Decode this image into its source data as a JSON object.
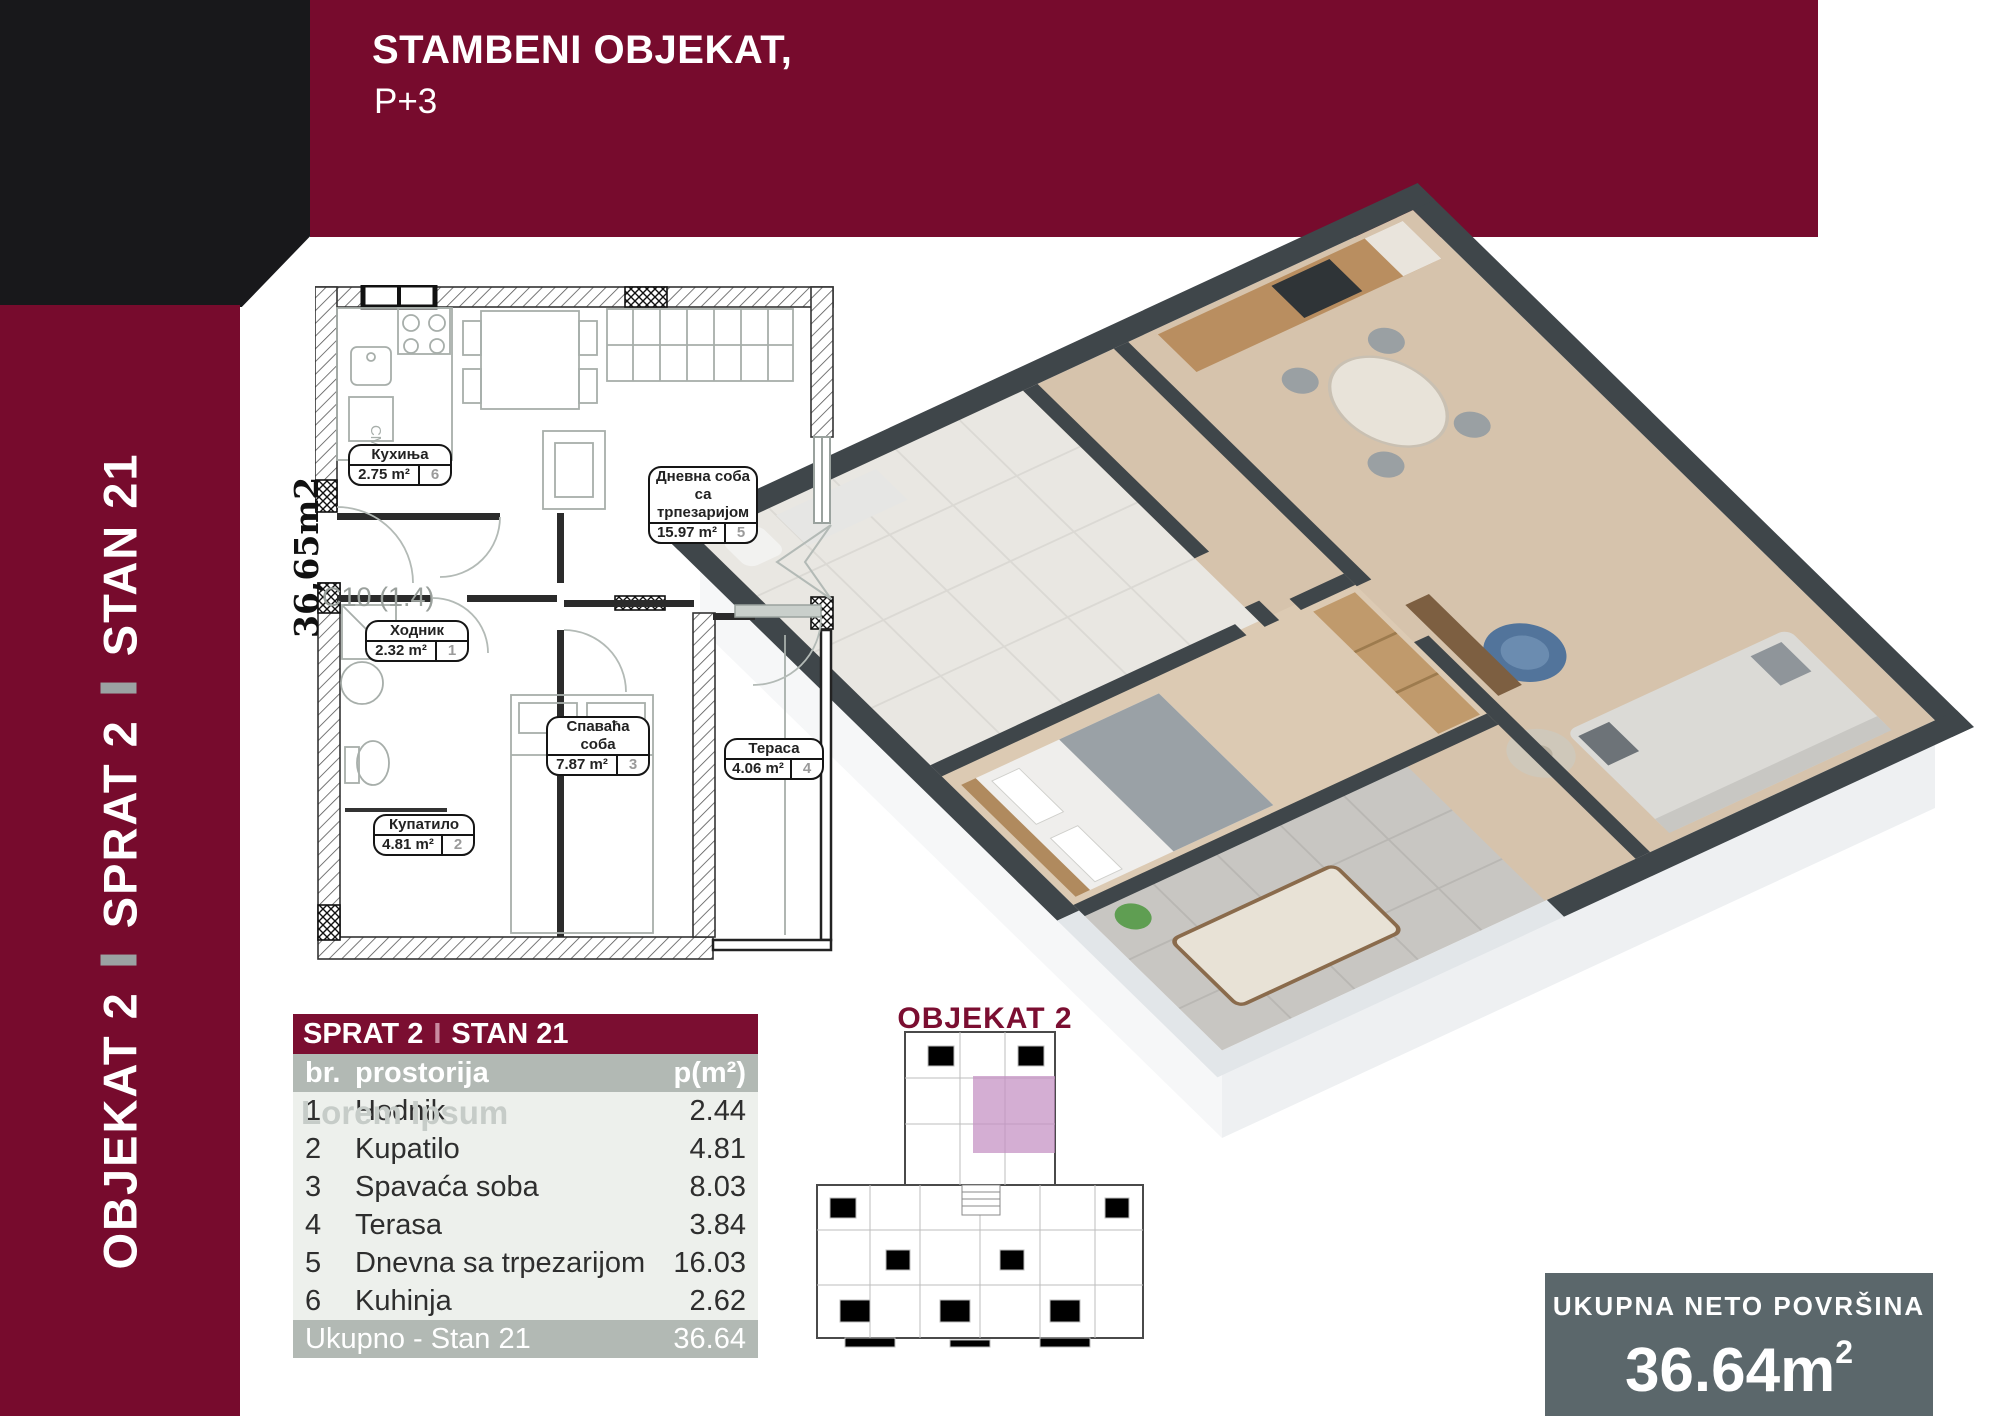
{
  "header": {
    "title": "STAMBENI OBJEKAT,",
    "subtitle": "P+3"
  },
  "sidebar": {
    "segments": [
      "OBJEKAT 2",
      "SPRAT 2",
      "STAN 21"
    ]
  },
  "floorplan": {
    "side_area": "36,65m2",
    "unit_code": "C10 (1.4)",
    "washer_label": "СМ",
    "rooms": [
      {
        "l1": "Кухиња",
        "l2": "",
        "area": "2.75 m²",
        "num": "6"
      },
      {
        "l1": "Дневна соба са",
        "l2": "трпезаријом",
        "area": "15.97 m²",
        "num": "5"
      },
      {
        "l1": "Ходник",
        "l2": "",
        "area": "2.32 m²",
        "num": "1"
      },
      {
        "l1": "Спаваћа соба",
        "l2": "",
        "area": "7.87 m²",
        "num": "3"
      },
      {
        "l1": "Купатило",
        "l2": "",
        "area": "4.81 m²",
        "num": "2"
      },
      {
        "l1": "Тераса",
        "l2": "",
        "area": "4.06 m²",
        "num": "4"
      }
    ]
  },
  "keyplan": {
    "title": "OBJEKAT 2"
  },
  "table": {
    "title1": "SPRAT 2",
    "title_sep": "I",
    "title2": "STAN 21",
    "watermark": "Lorem Ipsum",
    "headers": {
      "num": "br.",
      "room": "prostorija",
      "area": "p(m²)"
    },
    "rows": [
      [
        "1",
        "Hodnik",
        "2.44"
      ],
      [
        "2",
        "Kupatilo",
        "4.81"
      ],
      [
        "3",
        "Spavaća soba",
        "8.03"
      ],
      [
        "4",
        "Terasa",
        "3.84"
      ],
      [
        "5",
        "Dnevna sa trpezarijom",
        "16.03"
      ],
      [
        "6",
        "Kuhinja",
        "2.62"
      ]
    ],
    "footer": {
      "label": "Ukupno - Stan 21",
      "value": "36.64"
    }
  },
  "total_box": {
    "label": "UKUPNA NETO POVRŠINA",
    "value": "36.64m",
    "sup": "2"
  },
  "colors": {
    "maroon": "#770b2d",
    "black_corner": "#18181b",
    "table_gray": "#b2b9b4",
    "row_bg": "#edf0ec",
    "slate_box": "#5b676b",
    "wall_dark_3d": "#3f464a",
    "highlight_pink": "#c48fc2"
  }
}
